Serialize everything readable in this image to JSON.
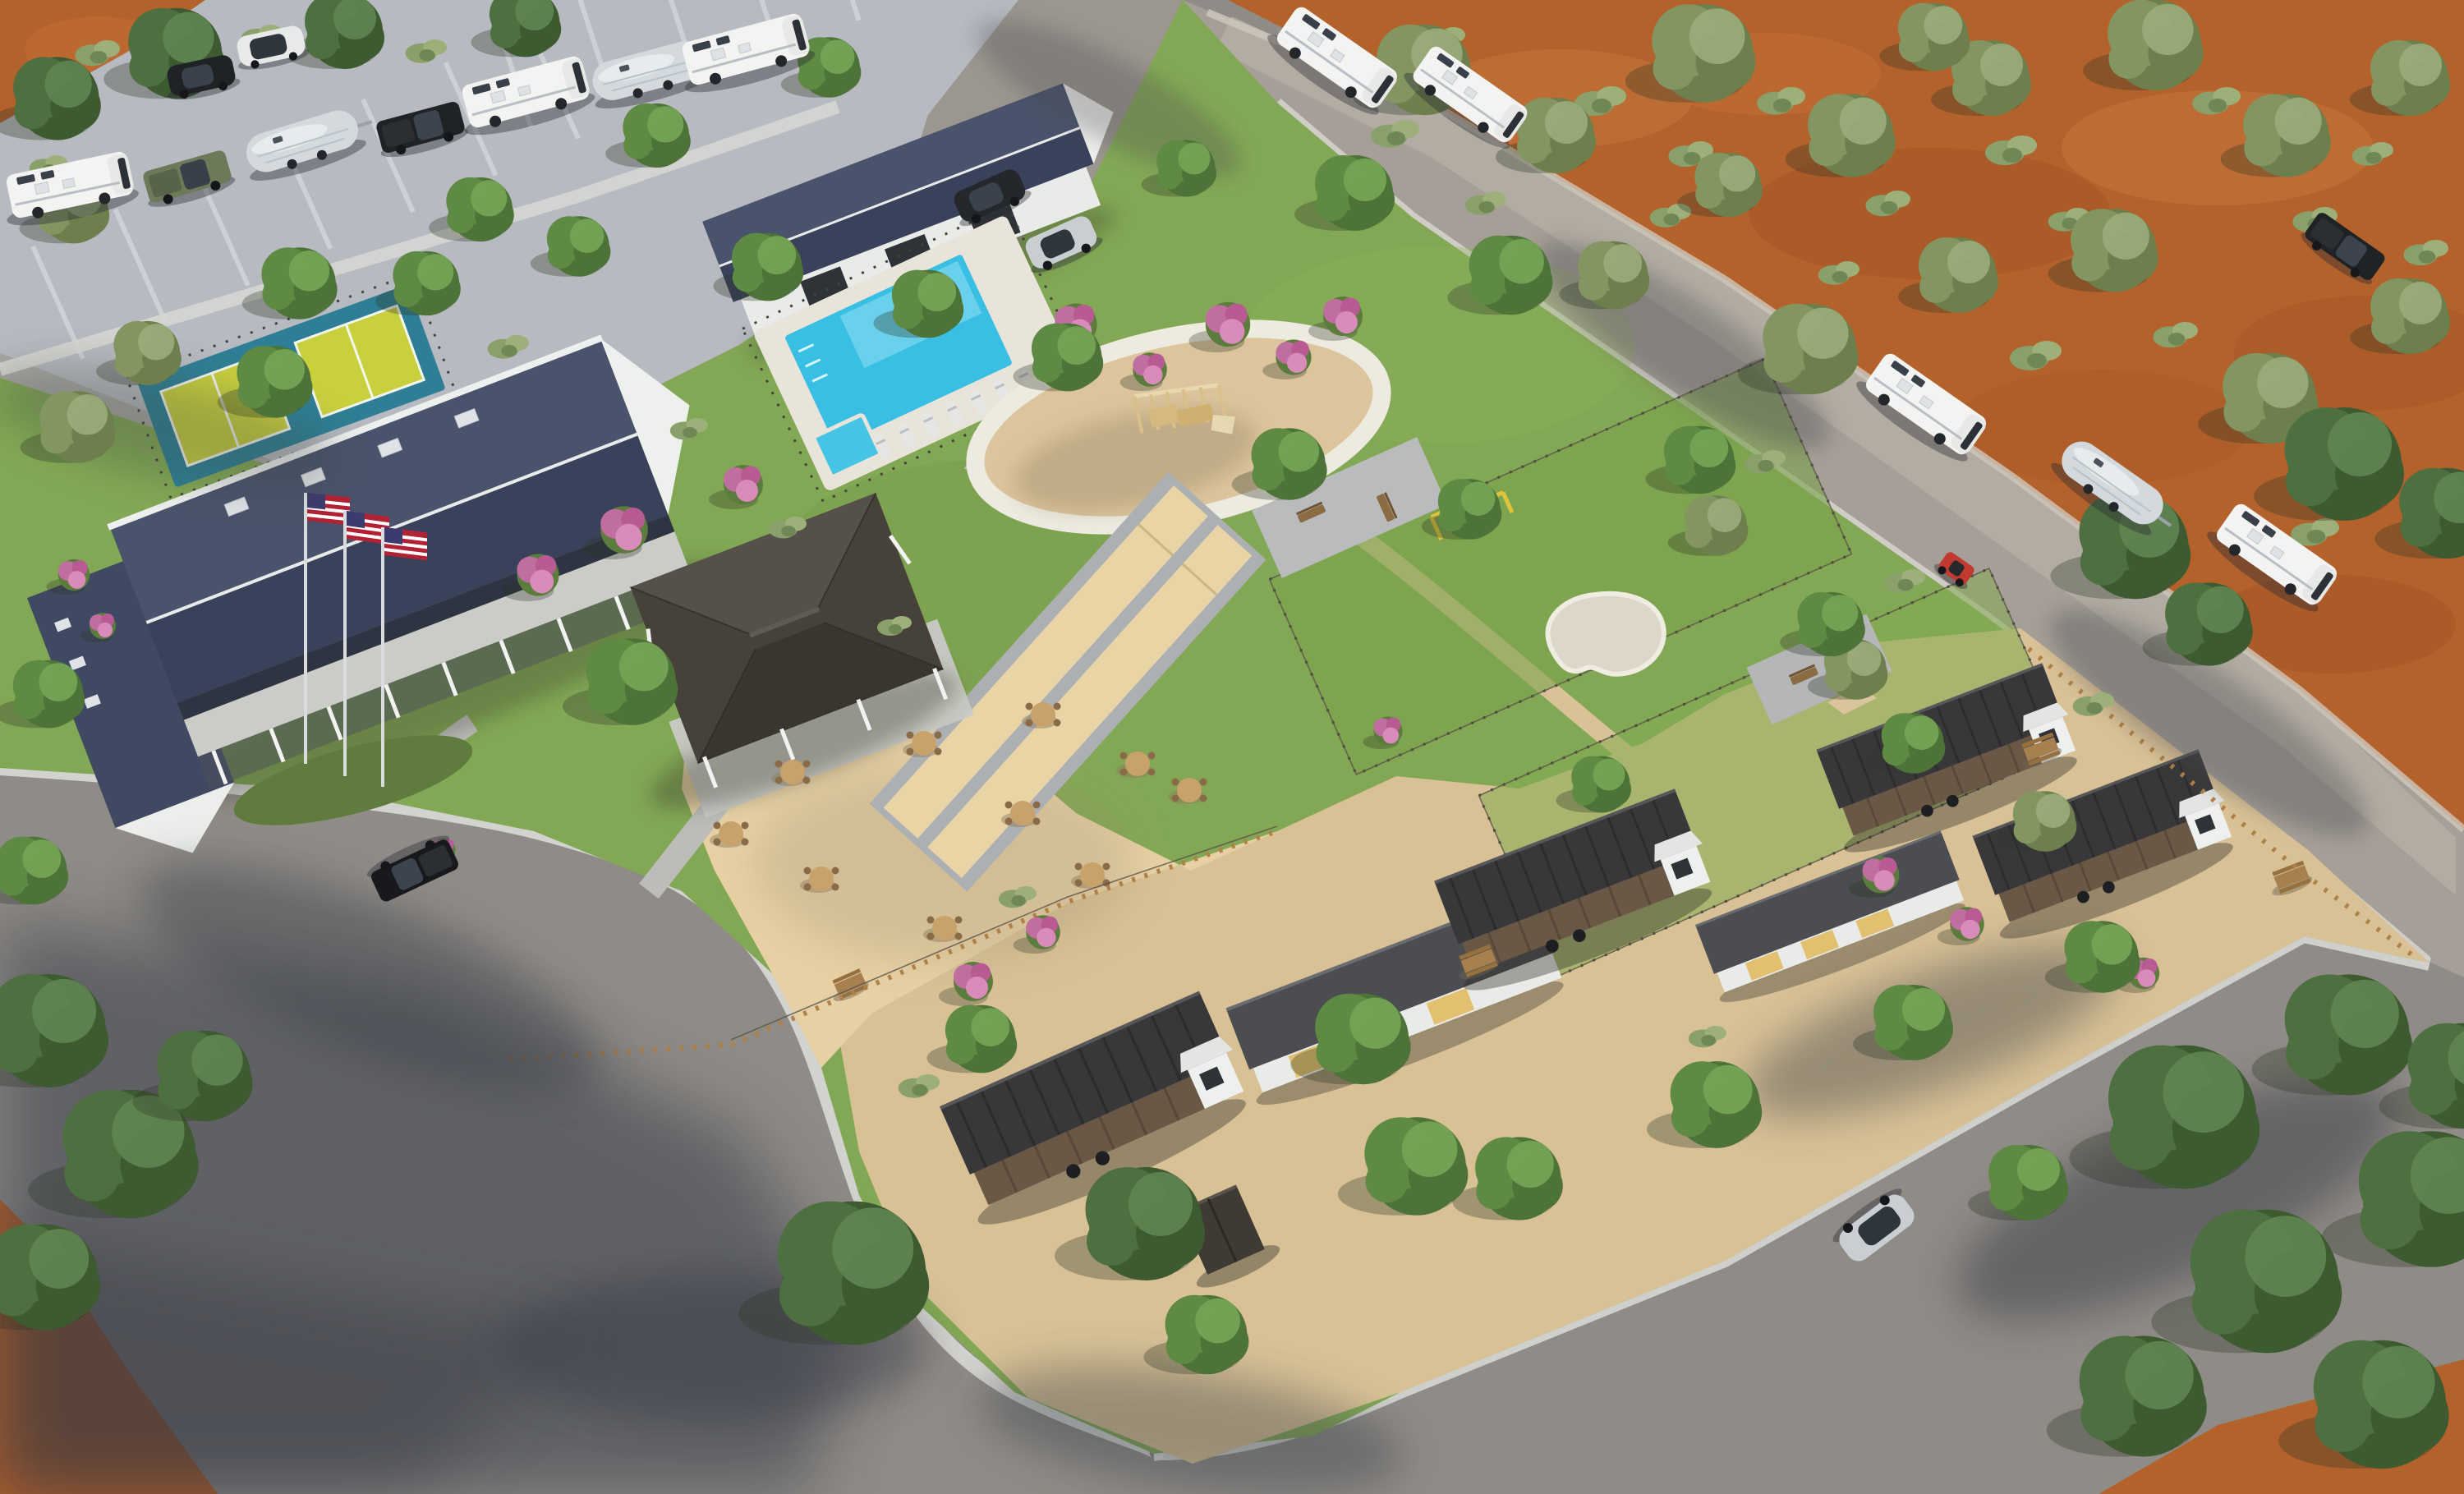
{
  "image": {
    "title": "Aerial 3D rendering of an RV resort and tiny-home campground",
    "type": "architectural-rendering",
    "time_of_day": "sunny daytime",
    "visible_text": ""
  },
  "palette": {
    "dirt": "#b4622c",
    "dirt_light": "#c97d3f",
    "dirt_dark": "#9c5224",
    "asphalt": "#8f8b86",
    "asphalt_shadow": "#343845",
    "concrete_parking": "#b7bac0",
    "road_warm": "#a69f97",
    "sidewalk": "#d6d7d3",
    "grass": "#83a855",
    "grass_dark": "#6e9347",
    "gravel": "#d8c195",
    "sand": "#e6d0a4",
    "playground_sand": "#dcc59c",
    "bocce_sand": "#e9d4a6",
    "pool_water": "#38bfe3",
    "pool_deck": "#e8e4da",
    "court_teal": "#2e7f95",
    "court_yellow": "#c9d03e",
    "roof_slate": "#49536b",
    "roof_slate_dark": "#39425a",
    "roof_charcoal": "#38383a",
    "pavilion_roof": "#474239",
    "cabin_wood": "#6a5847",
    "wall_white": "#eef0ee",
    "panel_yellow": "#e2c070",
    "wood_fence": "#b08046",
    "flower_pink": "#c06da0",
    "flag_red": "#b22234",
    "flag_blue": "#3c3b6e",
    "vehicle_white": "#f3f4f2",
    "vehicle_silver": "#c9ced2",
    "vehicle_black": "#1f2326",
    "vehicle_green": "#6c7a5a",
    "vehicle_red": "#c23a2f"
  },
  "scene": {
    "setting": "desert campground resort seen from the air, orange dirt terrain with olive trees around paved roads and landscaped grounds",
    "areas": [
      {
        "id": "rv-parking-lot",
        "label": "RV parking lot with angled stalls"
      },
      {
        "id": "desert-terrain",
        "label": "orange desert ground with olive trees and sage shrubs"
      },
      {
        "id": "access-road",
        "label": "curving asphalt access roads with concrete sidewalks"
      },
      {
        "id": "resort-lawn",
        "label": "landscaped lawn core of the resort"
      },
      {
        "id": "picnic-grounds",
        "label": "sand picnic grounds with round tables"
      },
      {
        "id": "cabin-village",
        "label": "gravel tiny-home cabin village"
      }
    ],
    "buildings": [
      {
        "id": "clubhouse",
        "label": "clubhouse with slate gable roof, wrap-around porch and three US flags"
      },
      {
        "id": "pool-house",
        "label": "pool house / garage building"
      },
      {
        "id": "pavilion",
        "label": "open-air pavilion with hip roof and white posts"
      },
      {
        "id": "bath-house",
        "label": "flat-roof bath house with yellow doors"
      },
      {
        "id": "service-building",
        "label": "flat-roof service building"
      },
      {
        "id": "cabins",
        "label": "tiny-home cabins on wheels, dark wood siding with white gables",
        "count": 4
      },
      {
        "id": "shed",
        "label": "small dark garden shed"
      }
    ],
    "amenities": [
      {
        "id": "pool",
        "label": "swimming pool with spa and sun loungers"
      },
      {
        "id": "pickleball",
        "label": "two pickleball courts, yellow on teal"
      },
      {
        "id": "playground",
        "label": "circular sand playground with timber play structure"
      },
      {
        "id": "bocce",
        "label": "two bocce ball lanes"
      },
      {
        "id": "dog-park",
        "label": "fenced dog park with agility gear and kidney-shaped sand pit"
      },
      {
        "id": "patios",
        "label": "paver patios with benches"
      },
      {
        "id": "flags",
        "label": "three American flags on poles",
        "count": 3
      }
    ],
    "vehicles": {
      "class_c_motorhomes": 7,
      "airstream_trailers": 3,
      "pickup_trucks": 4,
      "suv_and_cars": 4,
      "atv": 1
    },
    "landscape": {
      "tree_types": [
        "round deciduous",
        "olive",
        "large dark canopy"
      ],
      "flower_color": "pink crape myrtle",
      "picnic_tables": 10,
      "sun_loungers": 7
    }
  }
}
